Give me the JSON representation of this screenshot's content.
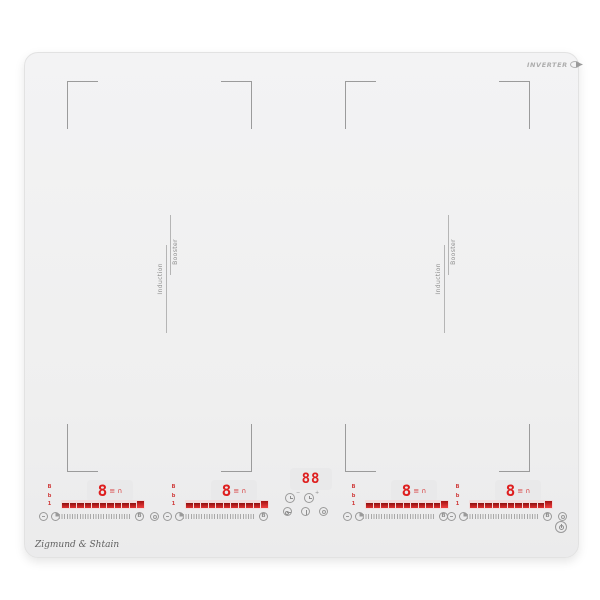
{
  "branding": {
    "inverter_logo": "INVERTER",
    "signature": "Zigmund & Shtain"
  },
  "flex_zones": {
    "induction_label": "Induction",
    "booster_label": "Booster"
  },
  "timer": {
    "display": "88",
    "minus_mark": "−",
    "plus_mark": "+"
  },
  "slider": {
    "segment_count": 11
  },
  "zones": [
    {
      "id": "zone-1",
      "power_display": "8",
      "display_icons": {
        "bars": "≡",
        "pot": "∩"
      },
      "indicator_marks": [
        "B",
        "b",
        "1"
      ],
      "booster_label": "B"
    },
    {
      "id": "zone-2",
      "power_display": "8",
      "display_icons": {
        "bars": "≡",
        "pot": "∩"
      },
      "indicator_marks": [
        "B",
        "b",
        "1"
      ],
      "booster_label": "B"
    },
    {
      "id": "zone-3",
      "power_display": "8",
      "display_icons": {
        "bars": "≡",
        "pot": "∩"
      },
      "indicator_marks": [
        "B",
        "b",
        "1"
      ],
      "booster_label": "B"
    },
    {
      "id": "zone-4",
      "power_display": "8",
      "display_icons": {
        "bars": "≡",
        "pot": "∩"
      },
      "indicator_marks": [
        "B",
        "b",
        "1"
      ],
      "booster_label": "B"
    }
  ],
  "colors": {
    "accent_red": "#de1f1f",
    "surface": "#f1f1f2",
    "icon_gray": "#9a9a9a"
  }
}
